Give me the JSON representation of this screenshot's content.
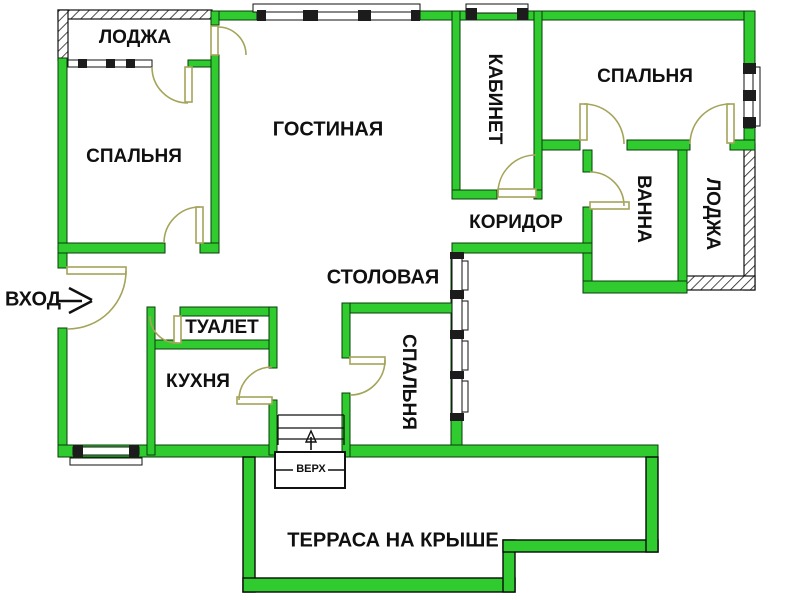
{
  "title": "Floor plan — apartment with roof terrace",
  "colors": {
    "wall_green": "#2fcb2f",
    "door_olive": "#a4a45a",
    "text": "#101010",
    "background": "#ffffff"
  },
  "rooms": [
    {
      "id": "loggia-top-left",
      "label": "ЛОДЖА",
      "orientation": "horizontal"
    },
    {
      "id": "bedroom-left",
      "label": "СПАЛЬНЯ",
      "orientation": "horizontal"
    },
    {
      "id": "living-room",
      "label": "ГОСТИНАЯ",
      "orientation": "horizontal"
    },
    {
      "id": "study",
      "label": "КАБИНЕТ",
      "orientation": "vertical"
    },
    {
      "id": "bedroom-top-right",
      "label": "СПАЛЬНЯ",
      "orientation": "horizontal"
    },
    {
      "id": "bathroom",
      "label": "ВАННА",
      "orientation": "vertical"
    },
    {
      "id": "loggia-right",
      "label": "ЛОДЖА",
      "orientation": "vertical"
    },
    {
      "id": "corridor",
      "label": "КОРИДОР",
      "orientation": "horizontal"
    },
    {
      "id": "dining-room",
      "label": "СТОЛОВАЯ",
      "orientation": "horizontal"
    },
    {
      "id": "toilet",
      "label": "ТУАЛЕТ",
      "orientation": "horizontal"
    },
    {
      "id": "kitchen",
      "label": "КУХНЯ",
      "orientation": "horizontal"
    },
    {
      "id": "bedroom-bottom",
      "label": "СПАЛЬНЯ",
      "orientation": "vertical"
    },
    {
      "id": "roof-terrace",
      "label": "ТЕРРАСА НА КРЫШЕ",
      "orientation": "horizontal"
    }
  ],
  "annotations": {
    "entrance": "ВХОД",
    "stairs_up": "ВЕРХ"
  }
}
